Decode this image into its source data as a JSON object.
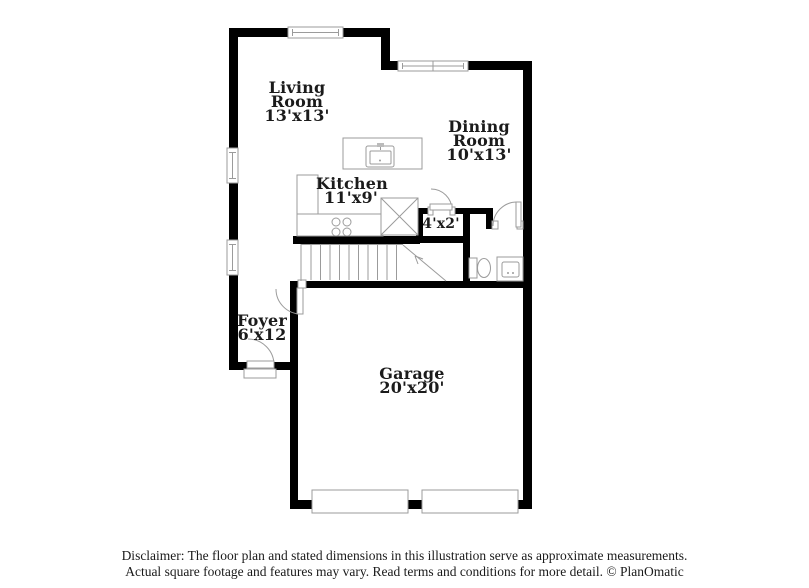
{
  "plan_title": "Floor plan",
  "rooms": [
    {
      "name": "Living Room",
      "dims": "13'x13'"
    },
    {
      "name": "Dining Room",
      "dims": "10'x13'"
    },
    {
      "name": "Kitchen",
      "dims": "11'x9'"
    },
    {
      "name": "",
      "dims": "4'x2'"
    },
    {
      "name": "Foyer",
      "dims": "6'x12"
    },
    {
      "name": "Garage",
      "dims": "20'x20'"
    }
  ],
  "disclaimer": {
    "line1": "Disclaimer: The floor plan and stated dimensions in this illustration serve as approximate measurements.",
    "line2": "Actual square footage and features may vary. Read terms and conditions for more detail. © PlanOmatic"
  },
  "colors": {
    "wall": "#000000",
    "fixture_line": "#9b9b9b",
    "background": "#ffffff",
    "text": "#1b1b1b"
  }
}
